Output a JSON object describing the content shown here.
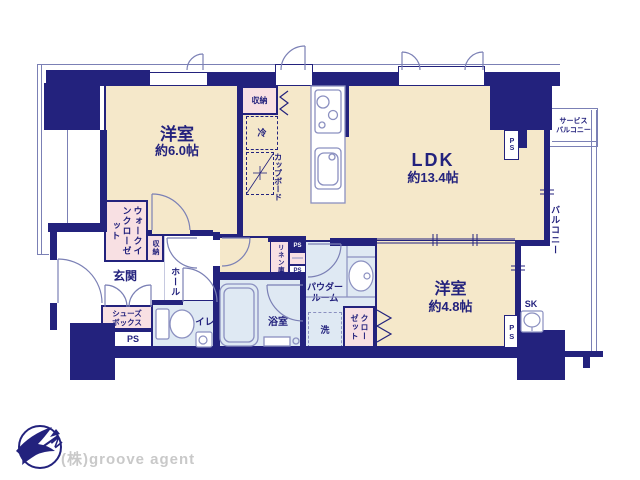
{
  "colors": {
    "wall": "#23227d",
    "room_fill": "#f5e8ca",
    "wet_area_fill": "#dfe9f3",
    "closet_fill": "#f8e0e3",
    "line": "#7b80b5",
    "fixture_line": "#8b90c0",
    "watermark_text": "#c9c9c9"
  },
  "rooms": {
    "bedroom6": {
      "name": "洋室",
      "size": "約6.0帖"
    },
    "ldk": {
      "name": "LDK",
      "size": "約13.4帖"
    },
    "bedroom48": {
      "name": "洋室",
      "size": "約4.8帖"
    }
  },
  "labels": {
    "storage": "収納",
    "fridge": "冷",
    "cupboard": "カップボード",
    "walk_in_closet": "ウォークインクローゼット",
    "entrance": "玄関",
    "hall": "ホール",
    "shoe_box": "シューズ\nボックス",
    "ps": "PS",
    "toilet": "トイレ",
    "bath": "浴室",
    "washer": "洗",
    "powder_room": "パウダー\nルーム",
    "linen": "リネン庫",
    "closet": "クローゼット",
    "sk": "SK",
    "balcony": "バルコニー",
    "service_balcony": "サービス\nバルコニー"
  },
  "branding": {
    "watermark": "(株)groove agent",
    "compass_letter": "N"
  }
}
